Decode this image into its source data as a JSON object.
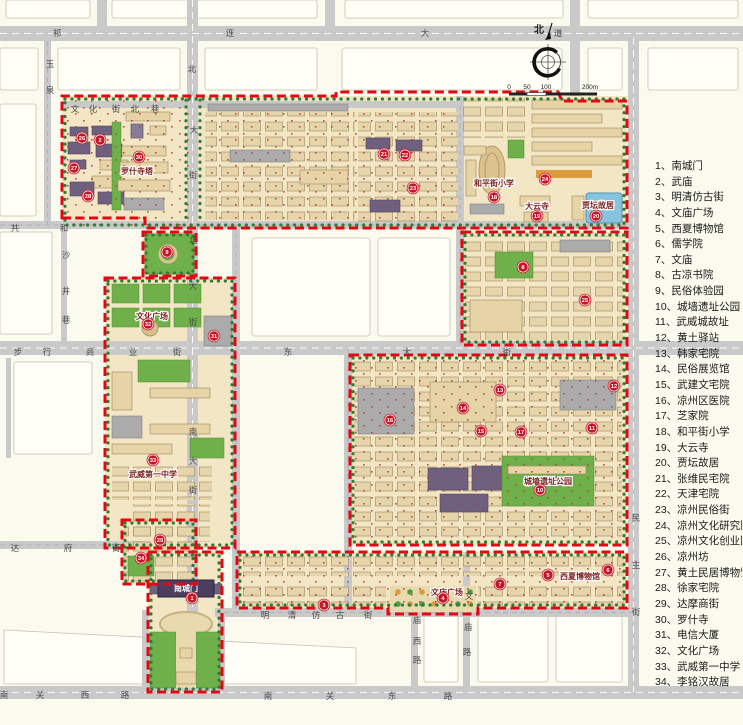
{
  "compass": {
    "north_label": "北"
  },
  "scale_bar": {
    "unit_ticks": [
      {
        "t": "0",
        "x": 509
      },
      {
        "t": "50",
        "x": 527
      },
      {
        "t": "100",
        "x": 546
      },
      {
        "t": "200m",
        "x": 590
      }
    ]
  },
  "legend": {
    "items": [
      {
        "no": "1",
        "label": "南城门"
      },
      {
        "no": "2",
        "label": "武庙"
      },
      {
        "no": "3",
        "label": "明清仿古街"
      },
      {
        "no": "4",
        "label": "文庙广场"
      },
      {
        "no": "5",
        "label": "西夏博物馆"
      },
      {
        "no": "6",
        "label": "儒学院"
      },
      {
        "no": "7",
        "label": "文庙"
      },
      {
        "no": "8",
        "label": "古凉书院"
      },
      {
        "no": "9",
        "label": "民俗体验园"
      },
      {
        "no": "10",
        "label": "城墙遗址公园"
      },
      {
        "no": "11",
        "label": "武威城故址"
      },
      {
        "no": "12",
        "label": "黄土驿站"
      },
      {
        "no": "13",
        "label": "韩家宅院"
      },
      {
        "no": "14",
        "label": "民俗展览馆"
      },
      {
        "no": "15",
        "label": "武建文宅院"
      },
      {
        "no": "16",
        "label": "凉州区医院"
      },
      {
        "no": "17",
        "label": "芝家院"
      },
      {
        "no": "18",
        "label": "和平街小学"
      },
      {
        "no": "19",
        "label": "大云寺"
      },
      {
        "no": "20",
        "label": "贾坛故居"
      },
      {
        "no": "21",
        "label": "张维民宅院"
      },
      {
        "no": "22",
        "label": "天津宅院"
      },
      {
        "no": "23",
        "label": "凉州民俗街"
      },
      {
        "no": "24",
        "label": "凉州文化研究院"
      },
      {
        "no": "25",
        "label": "凉州文化创业园"
      },
      {
        "no": "26",
        "label": "凉州坊"
      },
      {
        "no": "27",
        "label": "黄土民居博物馆"
      },
      {
        "no": "28",
        "label": "徐家宅院"
      },
      {
        "no": "29",
        "label": "达摩商街"
      },
      {
        "no": "30",
        "label": "罗什寺"
      },
      {
        "no": "31",
        "label": "电信大厦"
      },
      {
        "no": "32",
        "label": "文化广场"
      },
      {
        "no": "33",
        "label": "武威第一中学"
      },
      {
        "no": "34",
        "label": "李铭汉故居"
      }
    ]
  },
  "map": {
    "gate": {
      "label": "南城门"
    },
    "streets": [
      {
        "name": "祁连大道",
        "chars": [
          [
            "祁",
            57,
            36
          ],
          [
            "连",
            230,
            36
          ],
          [
            "大",
            425,
            36
          ],
          [
            "道",
            558,
            36
          ]
        ]
      },
      {
        "name": "共和街",
        "chars": [
          [
            "共",
            15,
            231
          ],
          [
            "和",
            64,
            231
          ]
        ]
      },
      {
        "name": "步行商业街",
        "chars": [
          [
            "步",
            18,
            355
          ],
          [
            "行",
            47,
            355
          ],
          [
            "商",
            90,
            355
          ],
          [
            "业",
            133,
            355
          ],
          [
            "街",
            177,
            355
          ]
        ]
      },
      {
        "name": "东大街",
        "chars": [
          [
            "东",
            288,
            355
          ],
          [
            "大",
            407,
            355
          ],
          [
            "街",
            507,
            355
          ]
        ]
      },
      {
        "name": "文化街北巷",
        "chars": [
          [
            "文",
            75,
            112
          ],
          [
            "化",
            93,
            112
          ],
          [
            "街",
            116,
            112
          ],
          [
            "北",
            135,
            112
          ],
          [
            "巷",
            155,
            112
          ]
        ]
      },
      {
        "name": "北大街",
        "chars": [
          [
            "北",
            192,
            72
          ],
          [
            "大",
            194,
            133
          ],
          [
            "街",
            193,
            178
          ],
          [
            "北",
            193,
            243
          ],
          [
            "大",
            193,
            289
          ],
          [
            "街",
            193,
            325
          ]
        ]
      },
      {
        "name": "南大街",
        "chars": [
          [
            "南",
            193,
            435
          ],
          [
            "大",
            193,
            464
          ],
          [
            "街",
            193,
            493
          ]
        ]
      },
      {
        "name": "玉泉路",
        "chars": [
          [
            "玉",
            50,
            67
          ],
          [
            "泉",
            50,
            93
          ]
        ]
      },
      {
        "name": "沙井巷",
        "chars": [
          [
            "沙",
            66,
            258
          ],
          [
            "井",
            66,
            294
          ],
          [
            "巷",
            66,
            323
          ]
        ]
      },
      {
        "name": "民主街",
        "chars": [
          [
            "民",
            636,
            521
          ],
          [
            "主",
            636,
            568
          ],
          [
            "街",
            636,
            615
          ]
        ]
      },
      {
        "name": "达府街",
        "chars": [
          [
            "达",
            15,
            551
          ],
          [
            "府",
            68,
            551
          ],
          [
            "街",
            116,
            551
          ]
        ]
      },
      {
        "name": "明清仿古街",
        "chars": [
          [
            "明",
            265,
            618
          ],
          [
            "清",
            292,
            618
          ],
          [
            "仿",
            316,
            618
          ],
          [
            "古",
            340,
            618
          ],
          [
            "街",
            368,
            618
          ]
        ]
      },
      {
        "name": "庙西路",
        "chars": [
          [
            "庙",
            417,
            623
          ],
          [
            "西",
            417,
            644
          ],
          [
            "路",
            417,
            663
          ]
        ]
      },
      {
        "name": "文庙路",
        "chars": [
          [
            "文",
            469,
            599
          ],
          [
            "庙",
            468,
            630
          ],
          [
            "路",
            467,
            655
          ]
        ]
      },
      {
        "name": "南关西路",
        "chars": [
          [
            "南",
            4,
            698
          ],
          [
            "关",
            40,
            698
          ],
          [
            "西",
            85,
            698
          ],
          [
            "路",
            125,
            698
          ]
        ]
      },
      {
        "name": "南关东路",
        "chars": [
          [
            "南",
            268,
            699
          ],
          [
            "关",
            330,
            699
          ],
          [
            "东",
            392,
            699
          ],
          [
            "路",
            448,
            699
          ]
        ]
      }
    ],
    "site_labels": [
      {
        "text": "罗什寺塔",
        "x": 137,
        "y": 174
      },
      {
        "text": "文化广场",
        "x": 152,
        "y": 319
      },
      {
        "text": "武威第一中学",
        "x": 153,
        "y": 477
      },
      {
        "text": "和平街小学",
        "x": 494,
        "y": 186
      },
      {
        "text": "大云寺",
        "x": 537,
        "y": 209
      },
      {
        "text": "贾坛故居",
        "x": 598,
        "y": 208
      },
      {
        "text": "城墙遗址公园",
        "x": 548,
        "y": 484
      },
      {
        "text": "文庙广场",
        "x": 447,
        "y": 595
      },
      {
        "text": "西夏博物馆",
        "x": 580,
        "y": 579
      }
    ],
    "markers": [
      {
        "no": "1",
        "x": 192,
        "y": 598
      },
      {
        "no": "2",
        "x": 100,
        "y": 140
      },
      {
        "no": "3",
        "x": 324,
        "y": 605
      },
      {
        "no": "4",
        "x": 443,
        "y": 598
      },
      {
        "no": "5",
        "x": 548,
        "y": 575
      },
      {
        "no": "6",
        "x": 608,
        "y": 570
      },
      {
        "no": "7",
        "x": 500,
        "y": 584
      },
      {
        "no": "8",
        "x": 523,
        "y": 267
      },
      {
        "no": "9",
        "x": 167,
        "y": 252
      },
      {
        "no": "10",
        "x": 540,
        "y": 490
      },
      {
        "no": "11",
        "x": 592,
        "y": 428
      },
      {
        "no": "12",
        "x": 614,
        "y": 386
      },
      {
        "no": "13",
        "x": 500,
        "y": 390
      },
      {
        "no": "14",
        "x": 463,
        "y": 408
      },
      {
        "no": "15",
        "x": 481,
        "y": 431
      },
      {
        "no": "16",
        "x": 390,
        "y": 420
      },
      {
        "no": "17",
        "x": 521,
        "y": 432
      },
      {
        "no": "18",
        "x": 494,
        "y": 197
      },
      {
        "no": "19",
        "x": 537,
        "y": 216
      },
      {
        "no": "20",
        "x": 596,
        "y": 216
      },
      {
        "no": "21",
        "x": 384,
        "y": 154
      },
      {
        "no": "22",
        "x": 405,
        "y": 155
      },
      {
        "no": "23",
        "x": 413,
        "y": 188
      },
      {
        "no": "24",
        "x": 545,
        "y": 179
      },
      {
        "no": "25",
        "x": 585,
        "y": 300
      },
      {
        "no": "26",
        "x": 82,
        "y": 138
      },
      {
        "no": "27",
        "x": 74,
        "y": 168
      },
      {
        "no": "28",
        "x": 88,
        "y": 196
      },
      {
        "no": "29",
        "x": 160,
        "y": 540
      },
      {
        "no": "30",
        "x": 139,
        "y": 157
      },
      {
        "no": "31",
        "x": 214,
        "y": 336
      },
      {
        "no": "32",
        "x": 148,
        "y": 324
      },
      {
        "no": "33",
        "x": 153,
        "y": 460
      },
      {
        "no": "34",
        "x": 141,
        "y": 558
      }
    ]
  }
}
